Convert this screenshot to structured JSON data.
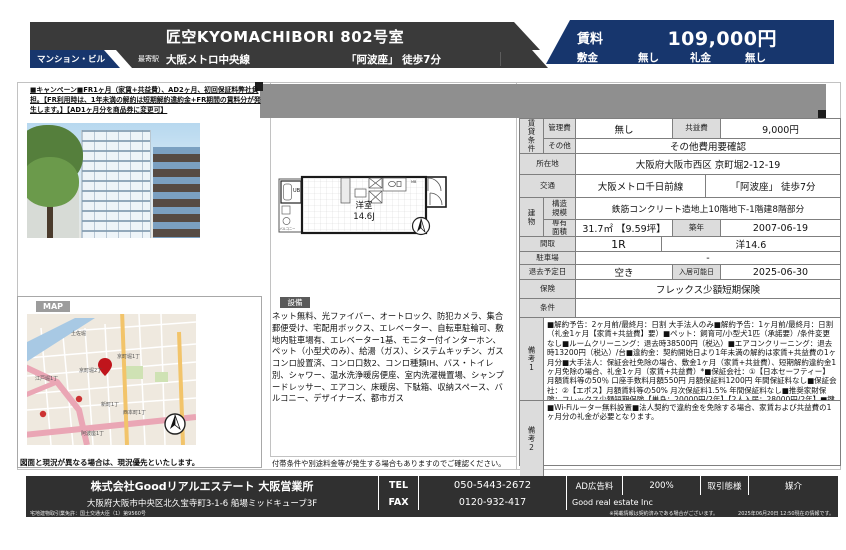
{
  "header": {
    "title": "匠空KYOMACHIBORI 802号室",
    "type_tag": "マンション・ビル",
    "station_label": "最寄駅",
    "station_line": "大阪メトロ中央線",
    "station_access": "「阿波座」 徒歩7分",
    "rent": {
      "label": "賃料",
      "value": "109,000円"
    },
    "deposit": {
      "label": "敷金",
      "value": "無し"
    },
    "key_money": {
      "label": "礼金",
      "value": "無し"
    },
    "accent_color": "#17366d",
    "bar_color": "#3a3a3a"
  },
  "campaign_note": "■キャンペーン■FR1ヶ月（家賃+共益費）、AD2ヶ月、初回保証料弊社負担。【FR利用時は、1年未満の解約は短期解約違約金+FR期間の賃料分が発生します。】【AD1ヶ月分を商品券に変更可】",
  "floorplan": {
    "room_label": "洋室",
    "room_size": "14.6J",
    "unit_bath": "UB",
    "balcony": "バルコニー",
    "mb": "MB"
  },
  "map_section": {
    "title": "MAP",
    "note": "図面と現況が異なる場合は、現況優先といたします。",
    "labels": [
      "土佐堀",
      "京町堀1丁",
      "京町堀2丁",
      "江戸堀1丁",
      "新町1丁",
      "西本町1丁",
      "阿波座1丁"
    ],
    "pin_color": "#c0151c"
  },
  "equipment": {
    "title": "設備",
    "text": "ネット無料、光ファイバー、オートロック、防犯カメラ、集合郵便受け、宅配用ボックス、エレベーター、自転車駐輪可、敷地内駐車場有、エレベーター1基、モニター付インターホン、ペット（小型犬のみ）、給湯（ガス）、システムキッチン、ガスコンロ設置済、コンロ口数2、コンロ種類IH、バス・トイレ別、シャワー、温水洗浄暖房便座、室内洗濯機置場、シャンプードレッサー、エアコン、床暖房、下駄箱、収納スペース、バルコニー、デザイナーズ、都市ガス",
    "note": "付帯条件や別途料金等が発生する場合もありますのでご確認ください。"
  },
  "details": {
    "group_rental": "賃貸条件",
    "mgmt_fee_label": "管理費",
    "mgmt_fee": "無し",
    "common_fee_label": "共益費",
    "common_fee": "9,000円",
    "other_label": "その他",
    "other": "その他費用要確認",
    "address_label": "所在地",
    "address": "大阪府大阪市西区 京町堀2-12-19",
    "access_label": "交通",
    "access_line": "大阪メトロ千日前線",
    "access_walk": "「阿波座」 徒歩7分",
    "group_building": "建物",
    "structure_label": "構造\n規模",
    "structure": "鉄筋コンクリート造地上10階地下-1階建8階部分",
    "area_label": "専有\n面積",
    "area": "31.7㎡ 【9.59坪】",
    "built_label": "築年",
    "built": "2007-06-19",
    "layout_label": "間取",
    "layout": "1R",
    "layout_detail": "洋14.6",
    "parking_label": "駐車場",
    "parking": "-",
    "moveout_label": "退去予定日",
    "moveout": "空き",
    "movein_label": "入居可能日",
    "movein": "2025-06-30",
    "insurance_label": "保険",
    "insurance": "フレックス少額短期保険",
    "condition_label": "条件",
    "condition": "",
    "note1_label": "備考1",
    "note1": "■解約予告：2ヶ月前/最終月：日割 大手法人のみ■解約予告：1ヶ月前/最終月：日割（礼金1ヶ月【家賃+共益費】要）■ペット：飼育可/小型犬1匹（承諾要）/条件変更なし■ルームクリーニング：退去時38500円（税込）■エアコンクリーニング：退去時13200円（税込）/台■違約金：契約開始日より1年未満の解約は家賃+共益費の1ヶ月分■大手法人：保証会社免除の場合、敷金1ヶ月（家賃+共益費）、短期解約違約金1ヶ月免除の場合、礼金1ヶ月（家賃+共益費）*■保証会社：①【日本セーフティー】月額賃料等の50％ 口座手数料月額550円 月額保証料1200円 年間保証料なし■保証会社：②【エポス】月額賃料等の50% 月次保証料1.5% 年間保証料なし■推奨家財保険：フレックス少額短期保険【単身：20000円/2年】【2人入居：28000円/2年】■鍵交換代18700円（込）入居時 ■消毒料16500円（込）入居時",
    "note2_label": "備考2",
    "note2": "■Wi-Fiルーター無料設置■法人契約で違約金を免除する場合、家賃および共益費の1ヶ月分の礼金が必要となります。"
  },
  "footer": {
    "company": "株式会社Goodリアルエステート 大阪営業所",
    "address": "大阪府大阪市中央区北久宝寺町3-1-6 船場ミッドキューブ3F",
    "tel_label": "TEL",
    "tel": "050-5443-2672",
    "fax_label": "FAX",
    "fax": "0120-932-417",
    "ad_label": "AD広告料",
    "ad": "200%",
    "deal_label": "取引態様",
    "deal": "媒介",
    "company_en": "Good real estate Inc",
    "license": "宅地建物取引業免許：国土交通大臣（1）第9560号",
    "disclaimer": "※掲載情報は契約済みである場合がございます。",
    "timestamp": "2025年06月20日 12:50現在の情報です。"
  }
}
